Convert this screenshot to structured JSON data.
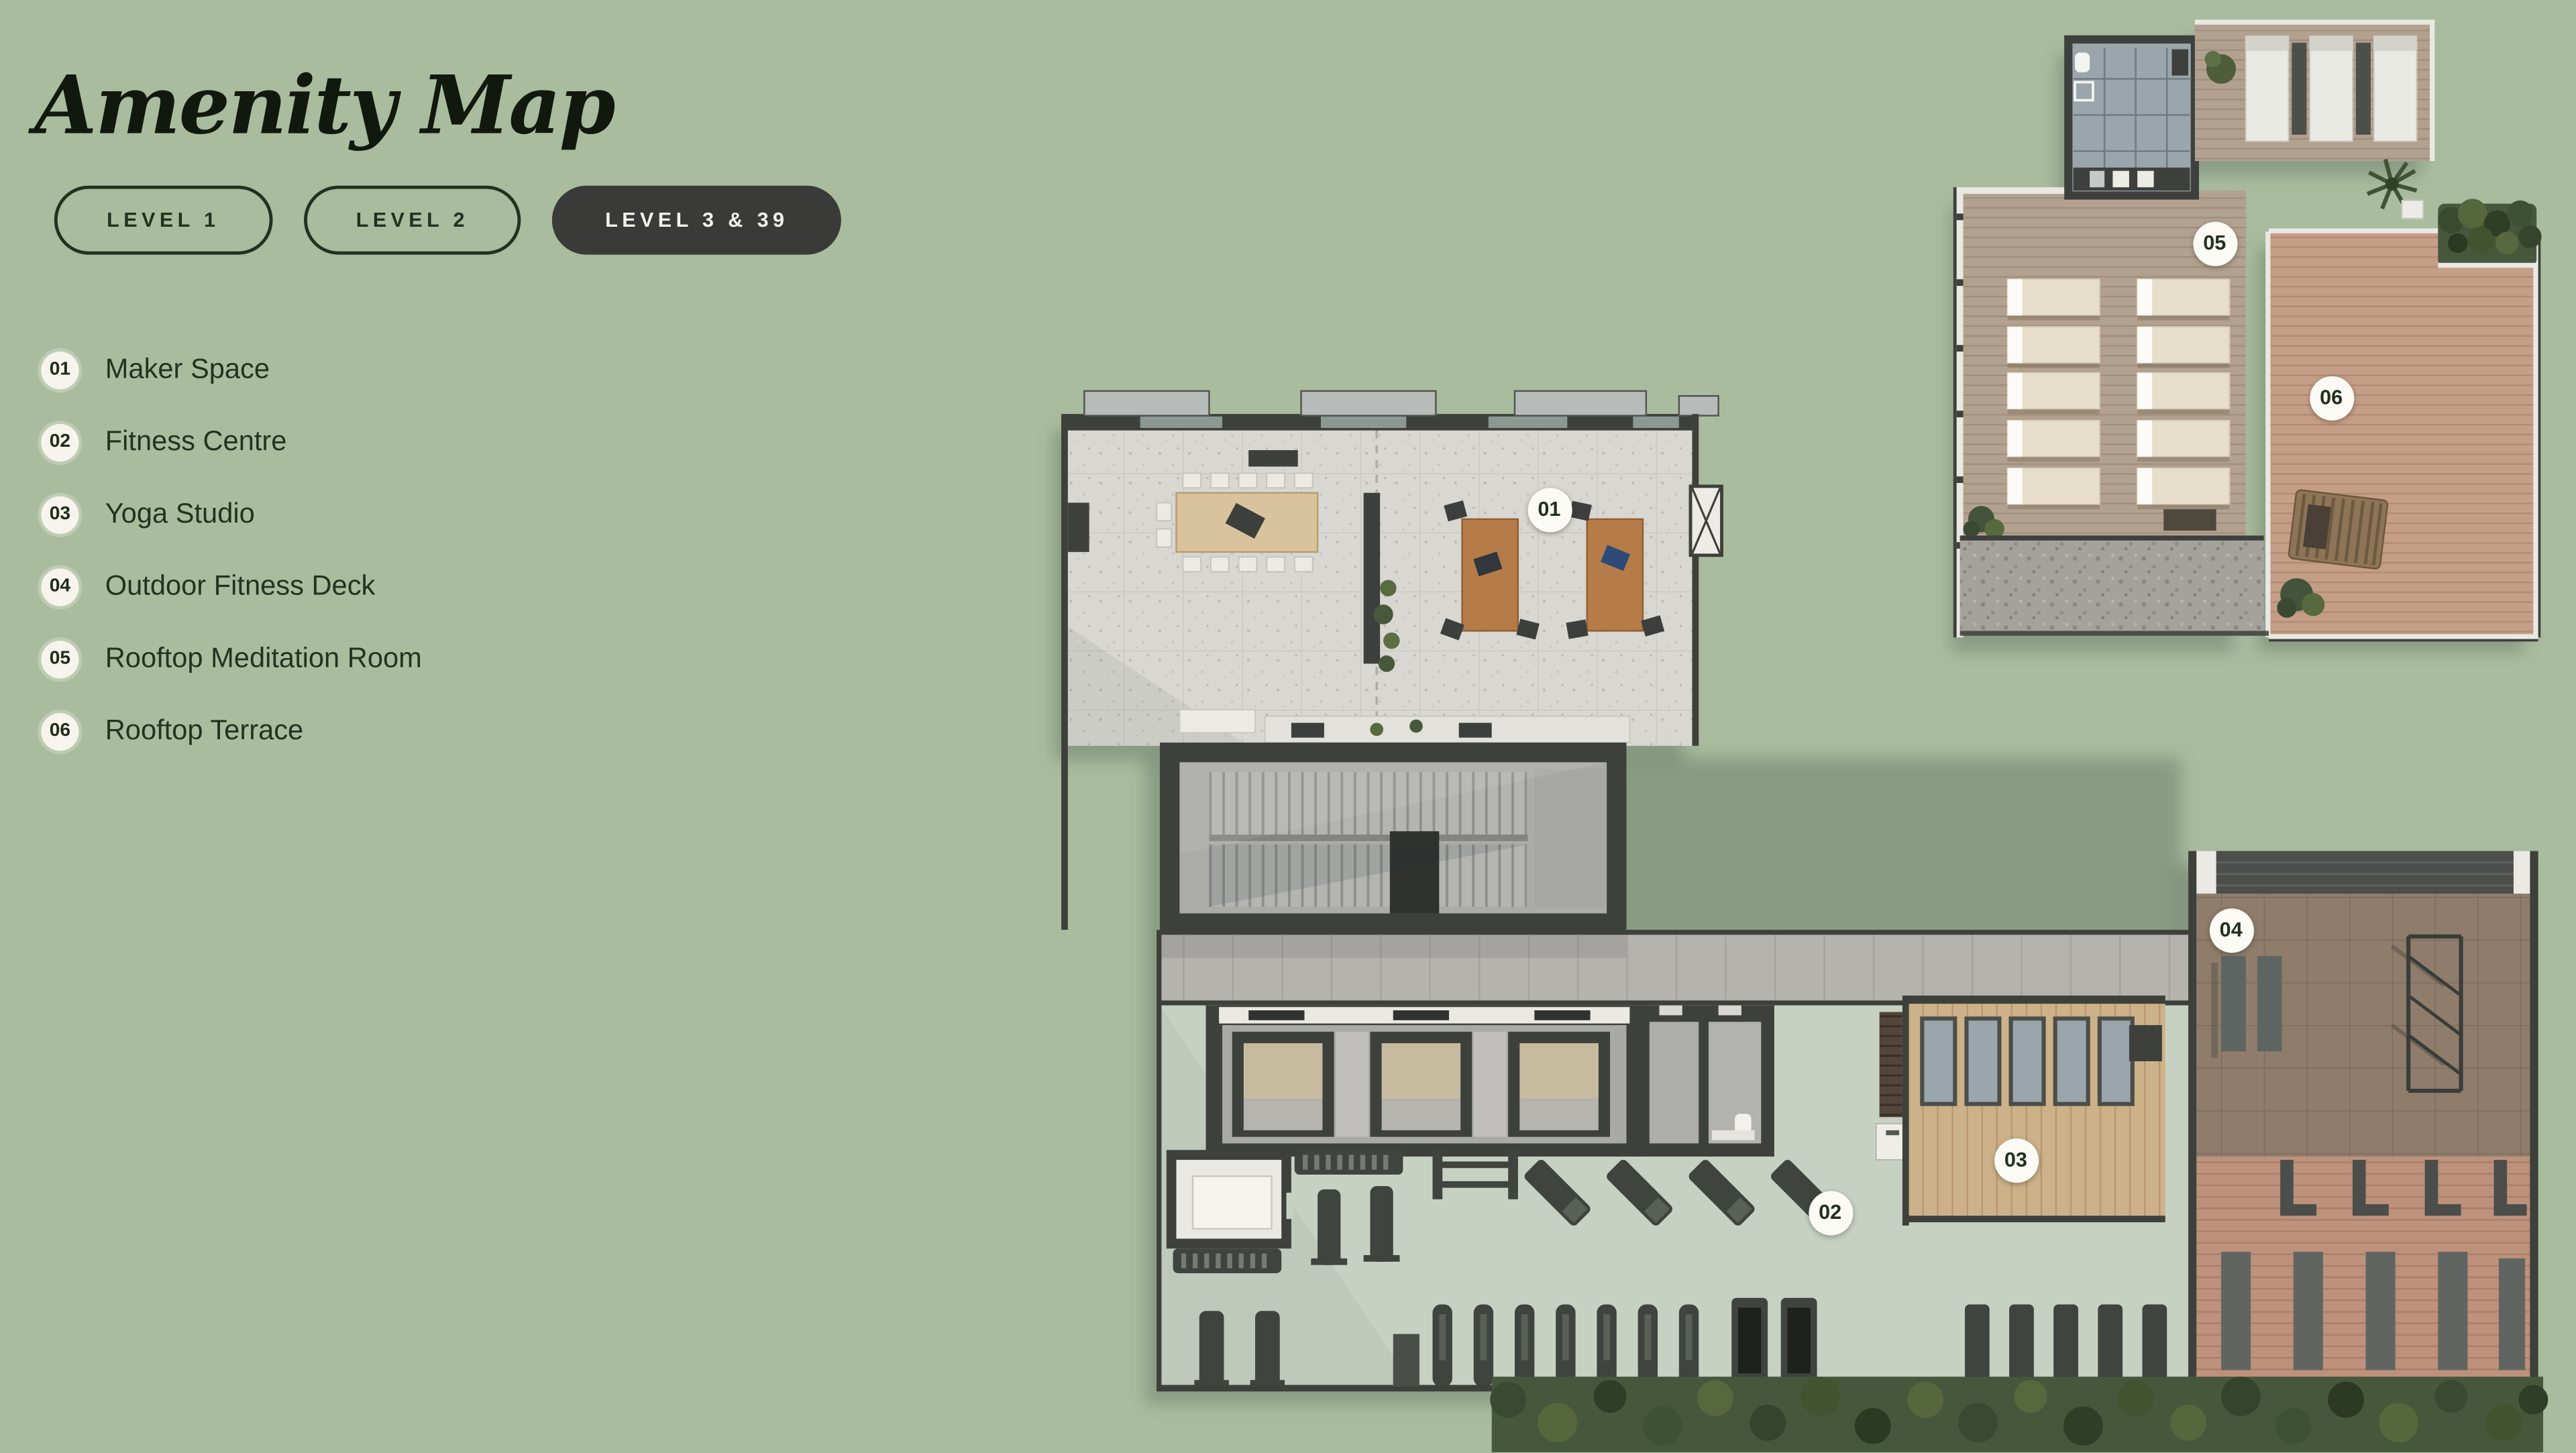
{
  "page": {
    "title": "Amenity Map"
  },
  "tabs": [
    {
      "label": "LEVEL 1",
      "active": false
    },
    {
      "label": "LEVEL 2",
      "active": false
    },
    {
      "label": "LEVEL 3 & 39",
      "active": true
    }
  ],
  "legend": {
    "items": [
      {
        "number": "01",
        "label": "Maker Space"
      },
      {
        "number": "02",
        "label": "Fitness Centre"
      },
      {
        "number": "03",
        "label": "Yoga Studio"
      },
      {
        "number": "04",
        "label": "Outdoor Fitness Deck"
      },
      {
        "number": "05",
        "label": "Rooftop Meditation Room"
      },
      {
        "number": "06",
        "label": "Rooftop Terrace"
      }
    ]
  },
  "map": {
    "markers": [
      {
        "number": "01"
      },
      {
        "number": "02"
      },
      {
        "number": "03"
      },
      {
        "number": "04"
      },
      {
        "number": "05"
      },
      {
        "number": "06"
      }
    ]
  },
  "colors": {
    "background": "#a9bd9e",
    "tab_active_bg": "#3a3a38",
    "tab_active_text": "#f3f2ed",
    "marker_bg": "#fbfaf5",
    "wall": "#3e403c",
    "terrazzo": "#d8d7d1",
    "fitness_floor": "#c7d1c3",
    "yoga_wood": "#cdb189",
    "deck_pavers": "#8f7c6b",
    "deck_wood": "#bd917b",
    "roof_deck": "#b3a18f",
    "terrace_deck": "#c59e87",
    "hedge": "#47573b",
    "gravel": "#a5a29b"
  }
}
